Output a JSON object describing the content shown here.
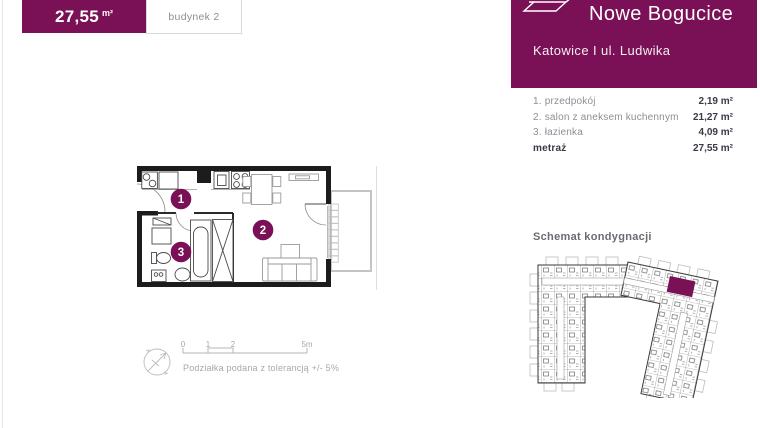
{
  "unit_card": {
    "area_value": "27,55",
    "area_unit": "m²",
    "building_label": "budynek 2"
  },
  "header": {
    "project_name": "Nowe Bogucice",
    "location": "Katowice I ul. Ludwika"
  },
  "room_list": {
    "rows": [
      {
        "label": "1. przedpokój",
        "area": "2,19 m²"
      },
      {
        "label": "2. salon z aneksem kuchennym",
        "area": "21,27 m²"
      },
      {
        "label": "3. łazienka",
        "area": "4,09 m²"
      }
    ],
    "total_label": "metraż",
    "total_area": "27,55 m²"
  },
  "schematic_section": {
    "title": "Schemat kondygnacji"
  },
  "floor_plan": {
    "room_badges": [
      "1",
      "2",
      "3"
    ]
  },
  "scale_bar": {
    "tick_labels": [
      "0",
      "1",
      "2",
      "5m"
    ],
    "tolerance_note": "Podziałka podana z tolerancją +/- 5%"
  },
  "colors": {
    "brand_purple": "#7a1055",
    "wall_black": "#1c1c1c",
    "light_gray": "#c4c4c4"
  }
}
